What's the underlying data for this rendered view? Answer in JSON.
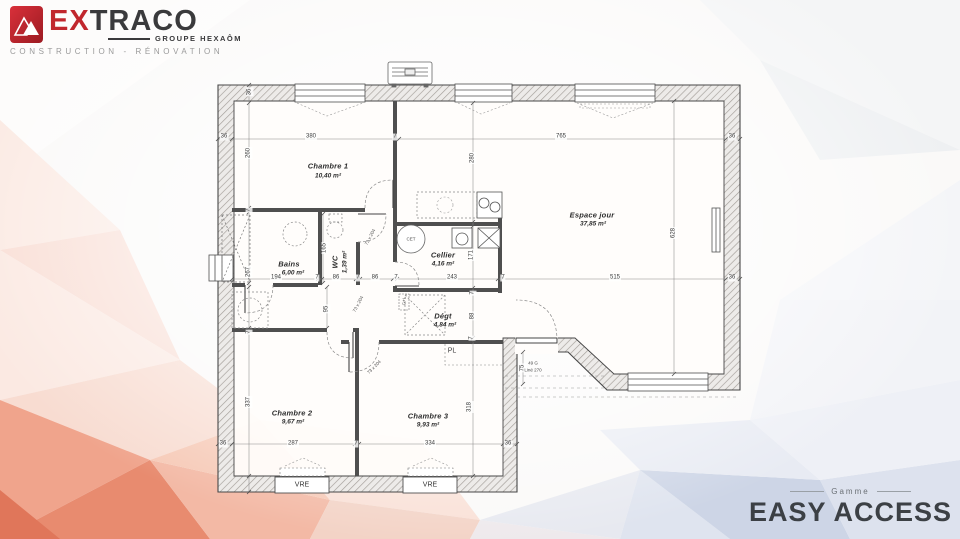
{
  "brand": {
    "name_ex": "EX",
    "name_traco": "TRACO",
    "group": "GROUPE HEXAÔM",
    "tagline": "CONSTRUCTION - RÉNOVATION",
    "logo_red": "#c1272d"
  },
  "range": {
    "label": "Gamme",
    "name": "EASY ACCESS"
  },
  "plan": {
    "rooms": {
      "chambre1": {
        "name": "Chambre 1",
        "area": "10,40 m²"
      },
      "bains": {
        "name": "Bains",
        "area": "6,00 m²"
      },
      "wc": {
        "name": "WC",
        "area": "1,39 m²"
      },
      "cellier": {
        "name": "Cellier",
        "area": "4,16 m²"
      },
      "espace_jour": {
        "name": "Espace jour",
        "area": "37,85 m²"
      },
      "degagement": {
        "name": "Dégt",
        "area": "4,84 m²"
      },
      "chambre2": {
        "name": "Chambre 2",
        "area": "9,67 m²"
      },
      "chambre3": {
        "name": "Chambre 3",
        "area": "9,93 m²"
      },
      "placard": {
        "name": "PL"
      }
    },
    "dims": {
      "top": [
        "36",
        "380",
        "7",
        "765",
        "36"
      ],
      "wall_thickness": "36",
      "left": [
        "260",
        "7",
        "267",
        "7",
        "337"
      ],
      "center_v": [
        "280",
        "171",
        "7",
        "88",
        "7",
        "318"
      ],
      "right": "628",
      "middle_h": [
        "194",
        "7",
        "86",
        "7",
        "86",
        "7",
        "243",
        "7",
        "515",
        "36"
      ],
      "bottom": [
        "36",
        "287",
        "7",
        "334",
        "36"
      ],
      "porch": "75",
      "wc_width": "165",
      "hall": "95"
    },
    "doors": {
      "size": "73 x 204"
    },
    "entry": {
      "line1": "49 G",
      "line2": "Liné 270"
    },
    "equipment": {
      "water_heater": "CET",
      "utility": "G+L",
      "shutters_label": "VRE"
    }
  }
}
